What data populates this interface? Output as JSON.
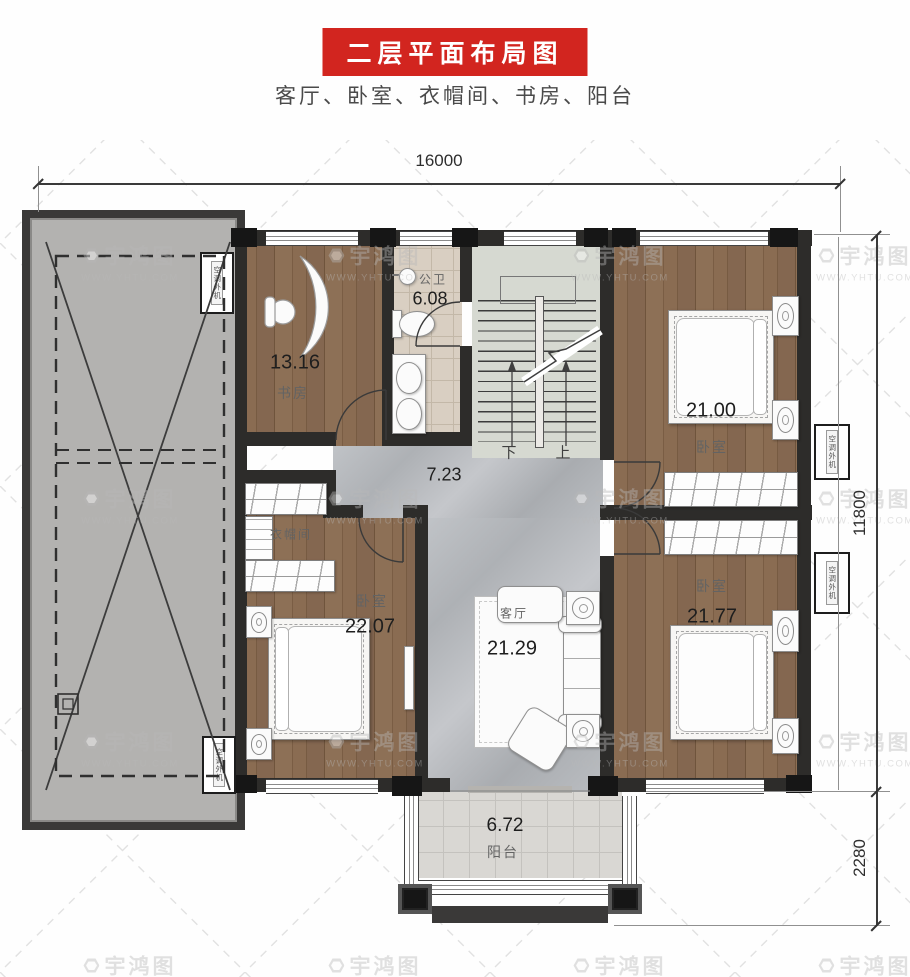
{
  "header": {
    "title": "二层平面布局图",
    "subtitle": "客厅、卧室、衣帽间、书房、阳台"
  },
  "dimensions": {
    "top_width": "16000",
    "side_main": "11800",
    "side_balcony": "2280"
  },
  "rooms": {
    "study": {
      "name": "书房",
      "area": "13.16"
    },
    "bathroom": {
      "name": "公卫",
      "area": "6.08"
    },
    "bedroom_top_right": {
      "name": "卧室",
      "area": "21.00"
    },
    "hallway": {
      "area": "7.23"
    },
    "cloakroom": {
      "name": "衣帽间"
    },
    "bedroom_bottom_left": {
      "name": "卧室",
      "area": "22.07"
    },
    "living_room": {
      "name": "客厅",
      "area": "21.29"
    },
    "bedroom_bottom_right": {
      "name": "卧室",
      "area": "21.77"
    },
    "balcony": {
      "name": "阳台",
      "area": "6.72"
    }
  },
  "stairs": {
    "down_label": "下",
    "up_label": "上"
  },
  "equipment": {
    "ac_unit": "空调外机"
  },
  "watermark": {
    "brand": "宇鸿图",
    "site": "WWW.YHTU.COM"
  },
  "colors": {
    "accent_red": "#d2251f",
    "wall": "#2d2c2a",
    "wood_floor": "#83654c",
    "marble_floor": "#b7babd",
    "bath_tile": "#d9cfc2",
    "balcony_tile": "#d9d7d3",
    "roof_gray": "#b3b2b0"
  }
}
